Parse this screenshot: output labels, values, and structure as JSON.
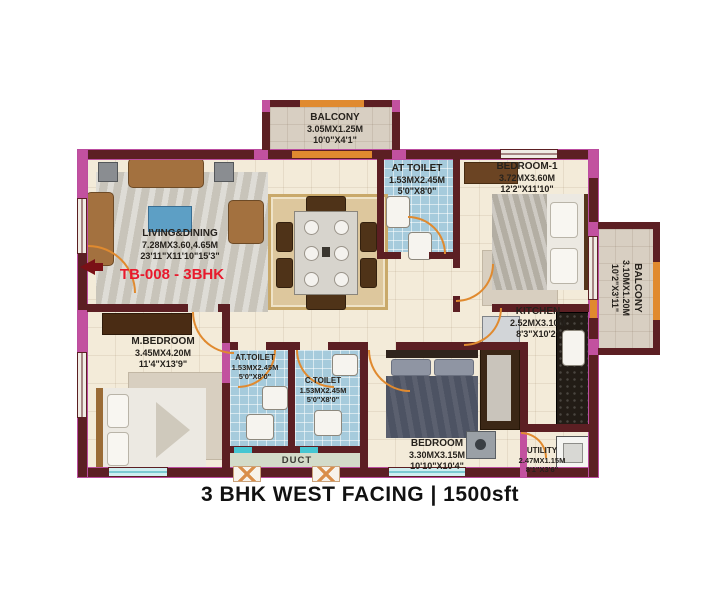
{
  "title": "3 BHK WEST FACING | 1500sft",
  "plan_code": "TB-008 - 3BHK",
  "rooms": {
    "balcony_top": {
      "name": "BALCONY",
      "metric": "3.05MX1.25M",
      "imperial": "10'0\"X4'1\""
    },
    "at_toilet_top": {
      "name": "AT TOILET",
      "metric": "1.53MX2.45M",
      "imperial": "5'0\"X8'0\""
    },
    "bedroom_1": {
      "name": "BEDROOM-1",
      "metric": "3.72MX3.60M",
      "imperial": "12'2\"X11'10\""
    },
    "living_dining": {
      "name": "LIVING&DINING",
      "metric": "7.28MX3.60,4.65M",
      "imperial": "23'11\"X11'10\"15'3\""
    },
    "balcony_right": {
      "name": "BALCONY",
      "metric": "3.10MX1.20M",
      "imperial": "10'2\"X3'11\""
    },
    "kitchen": {
      "name": "KITCHEN",
      "metric": "2.52MX3.10M",
      "imperial": "8'3\"X10'2\""
    },
    "m_bedroom": {
      "name": "M.BEDROOM",
      "metric": "3.45MX4.20M",
      "imperial": "11'4\"X13'9\""
    },
    "at_toilet_bottom": {
      "name": "AT.TOILET",
      "metric": "1.53MX2.45M",
      "imperial": "5'0\"X8'0\""
    },
    "c_toilet": {
      "name": "C.TOILET",
      "metric": "1.53MX2.45M",
      "imperial": "5'0\"X8'0\""
    },
    "bedroom_bottom": {
      "name": "BEDROOM",
      "metric": "3.30MX3.15M",
      "imperial": "10'10\"X10'4\""
    },
    "utility": {
      "name": "UTILITY",
      "metric": "2.47MX1.15M",
      "imperial": "8'1\"X3'6\""
    },
    "duct": {
      "name": "DUCT"
    }
  },
  "colors": {
    "wall": "#5c1f23",
    "wall_accent_pink": "#c2519f",
    "door_orange": "#e08a2f",
    "toilet_floor": "#a6cbdc",
    "floor": "#f3ebd9",
    "plan_code_red": "#e8192c"
  }
}
